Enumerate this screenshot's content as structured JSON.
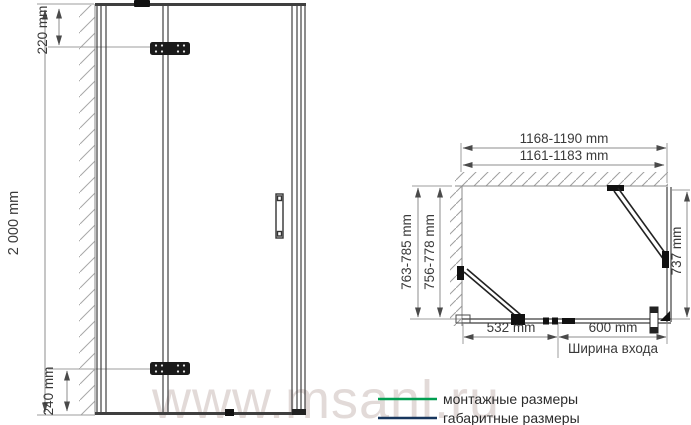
{
  "watermark": "www.msanl.ru",
  "colors": {
    "mounting_green": "#009e50",
    "overall_navy": "#17365d",
    "dim_text": "#3a3a3a"
  },
  "front_view": {
    "height_label": "2 000 mm",
    "top_hinge_offset_label": "220 mm",
    "bottom_hinge_offset_label": "240 mm"
  },
  "top_view": {
    "overall_width_label": "1168-1190 mm",
    "mounting_width_label": "1161-1183 mm",
    "overall_depth_label": "763-785 mm",
    "mounting_depth_label": "756-778 mm",
    "side_panel_depth_label": "737 mm",
    "fixed_section_label": "532 mm",
    "entrance_width_label": "600 mm",
    "entrance_caption": "Ширина входа"
  },
  "legend": {
    "mounting_label": "монтажные размеры",
    "overall_label": "габаритные размеры"
  }
}
